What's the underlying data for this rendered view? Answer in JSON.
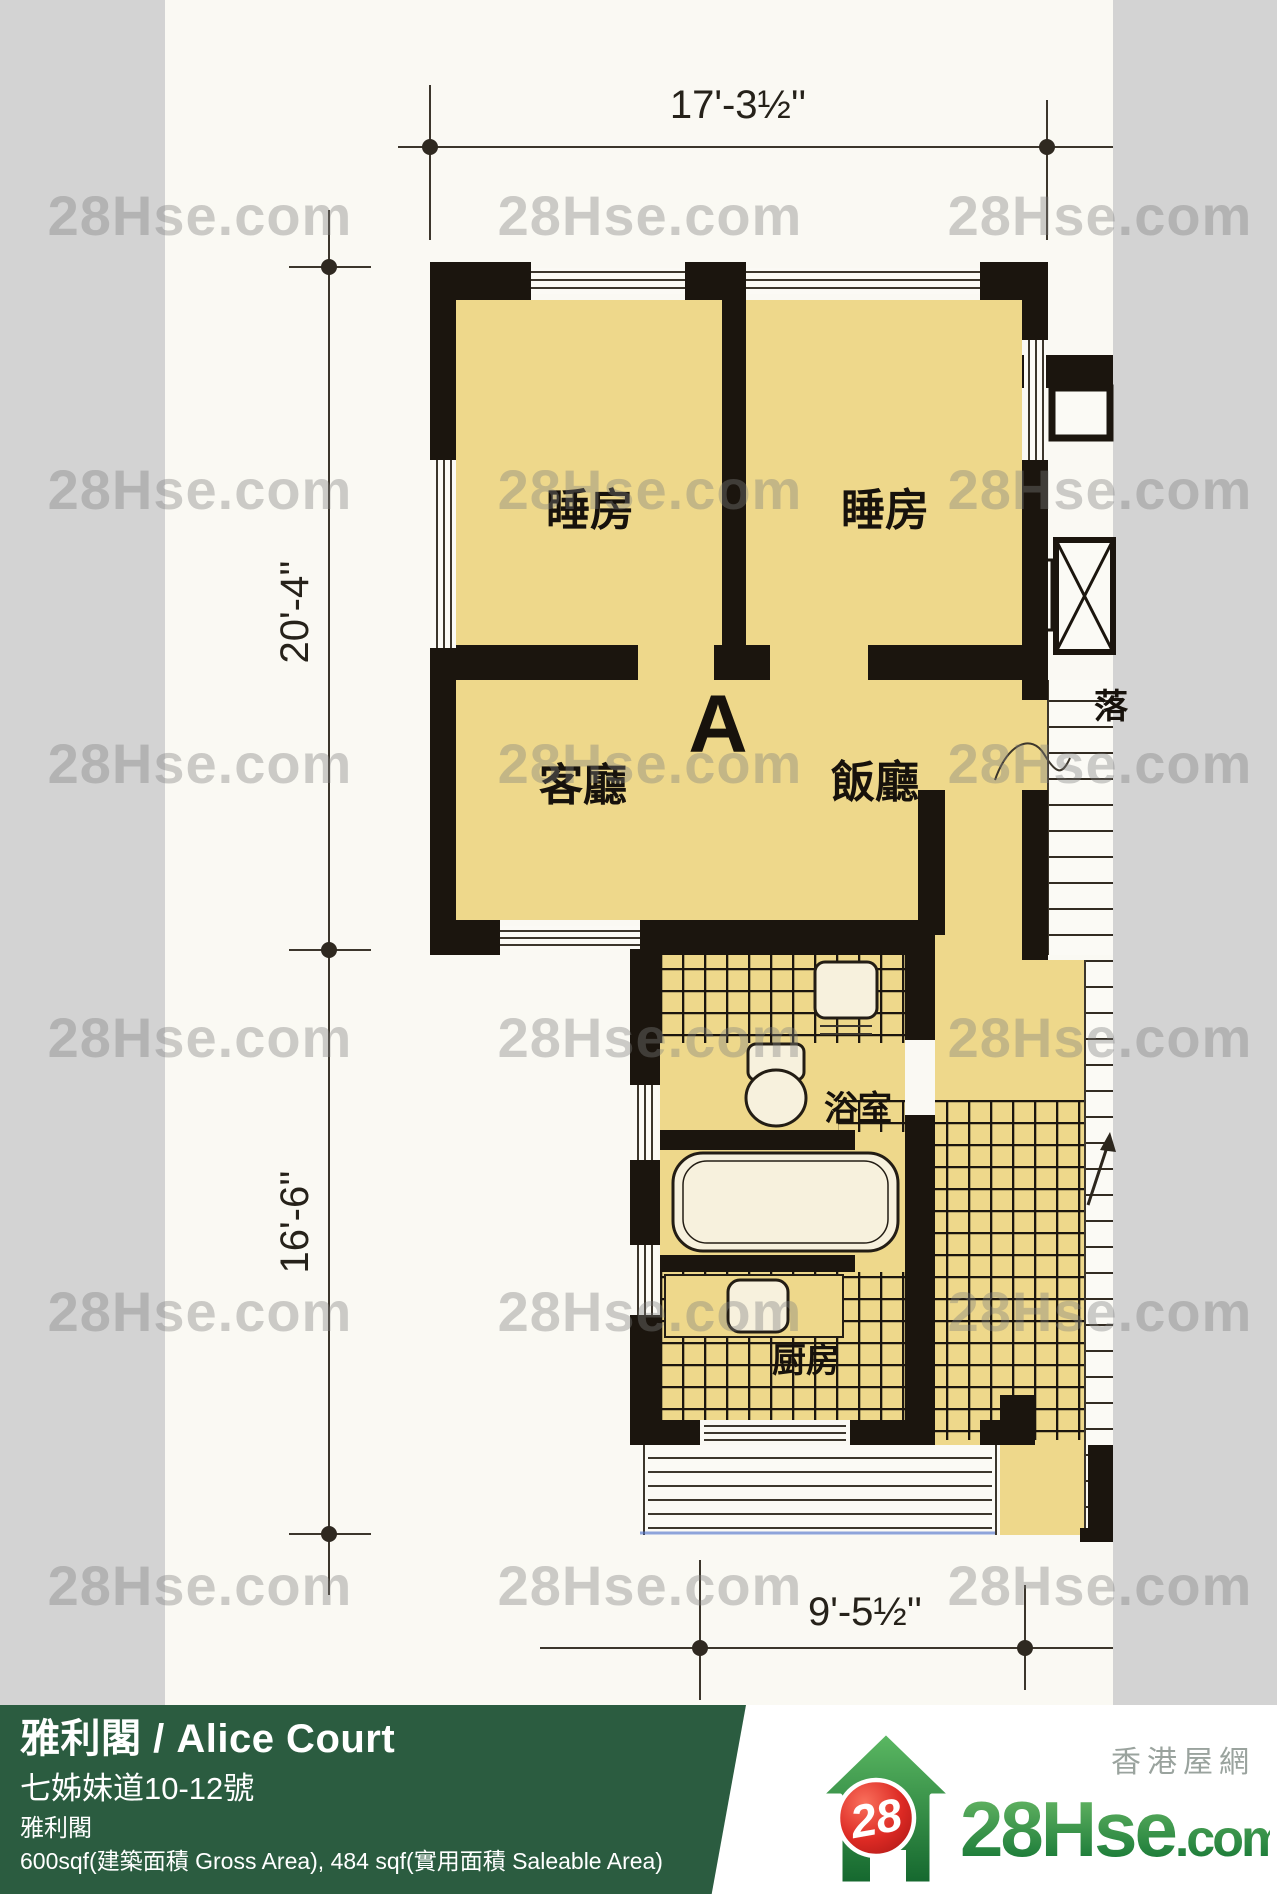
{
  "watermark": {
    "text": "28Hse.com"
  },
  "floor_plan": {
    "unit_label": "A",
    "rooms": {
      "bedroom1": "睡房",
      "bedroom2": "睡房",
      "living": "客廳",
      "dining": "飯廳",
      "bathroom": "浴室",
      "kitchen": "厨房"
    },
    "dimensions": {
      "top": "17'-3½''",
      "left_upper": "20'-4''",
      "left_lower": "16'-6''",
      "bottom": "9'-5½''"
    },
    "corridor_char": "落",
    "colors": {
      "room_fill": "#eed88b",
      "wall": "#1b150e",
      "paper": "#faf9f3"
    }
  },
  "info_bar": {
    "title": "雅利閣 / Alice Court",
    "address": "七姊妹道10-12號",
    "building": "雅利閣",
    "area": "600sqf(建築面積 Gross Area), 484 sqf(實用面積 Saleable Area)",
    "bg_color": "#2b5c40"
  },
  "logo": {
    "badge_number": "28",
    "site_name_main": "28Hse",
    "site_name_tld": ".com",
    "site_name_cn": "香港屋網",
    "brand_green": "#1e7e3a",
    "brand_red": "#c9201f"
  }
}
